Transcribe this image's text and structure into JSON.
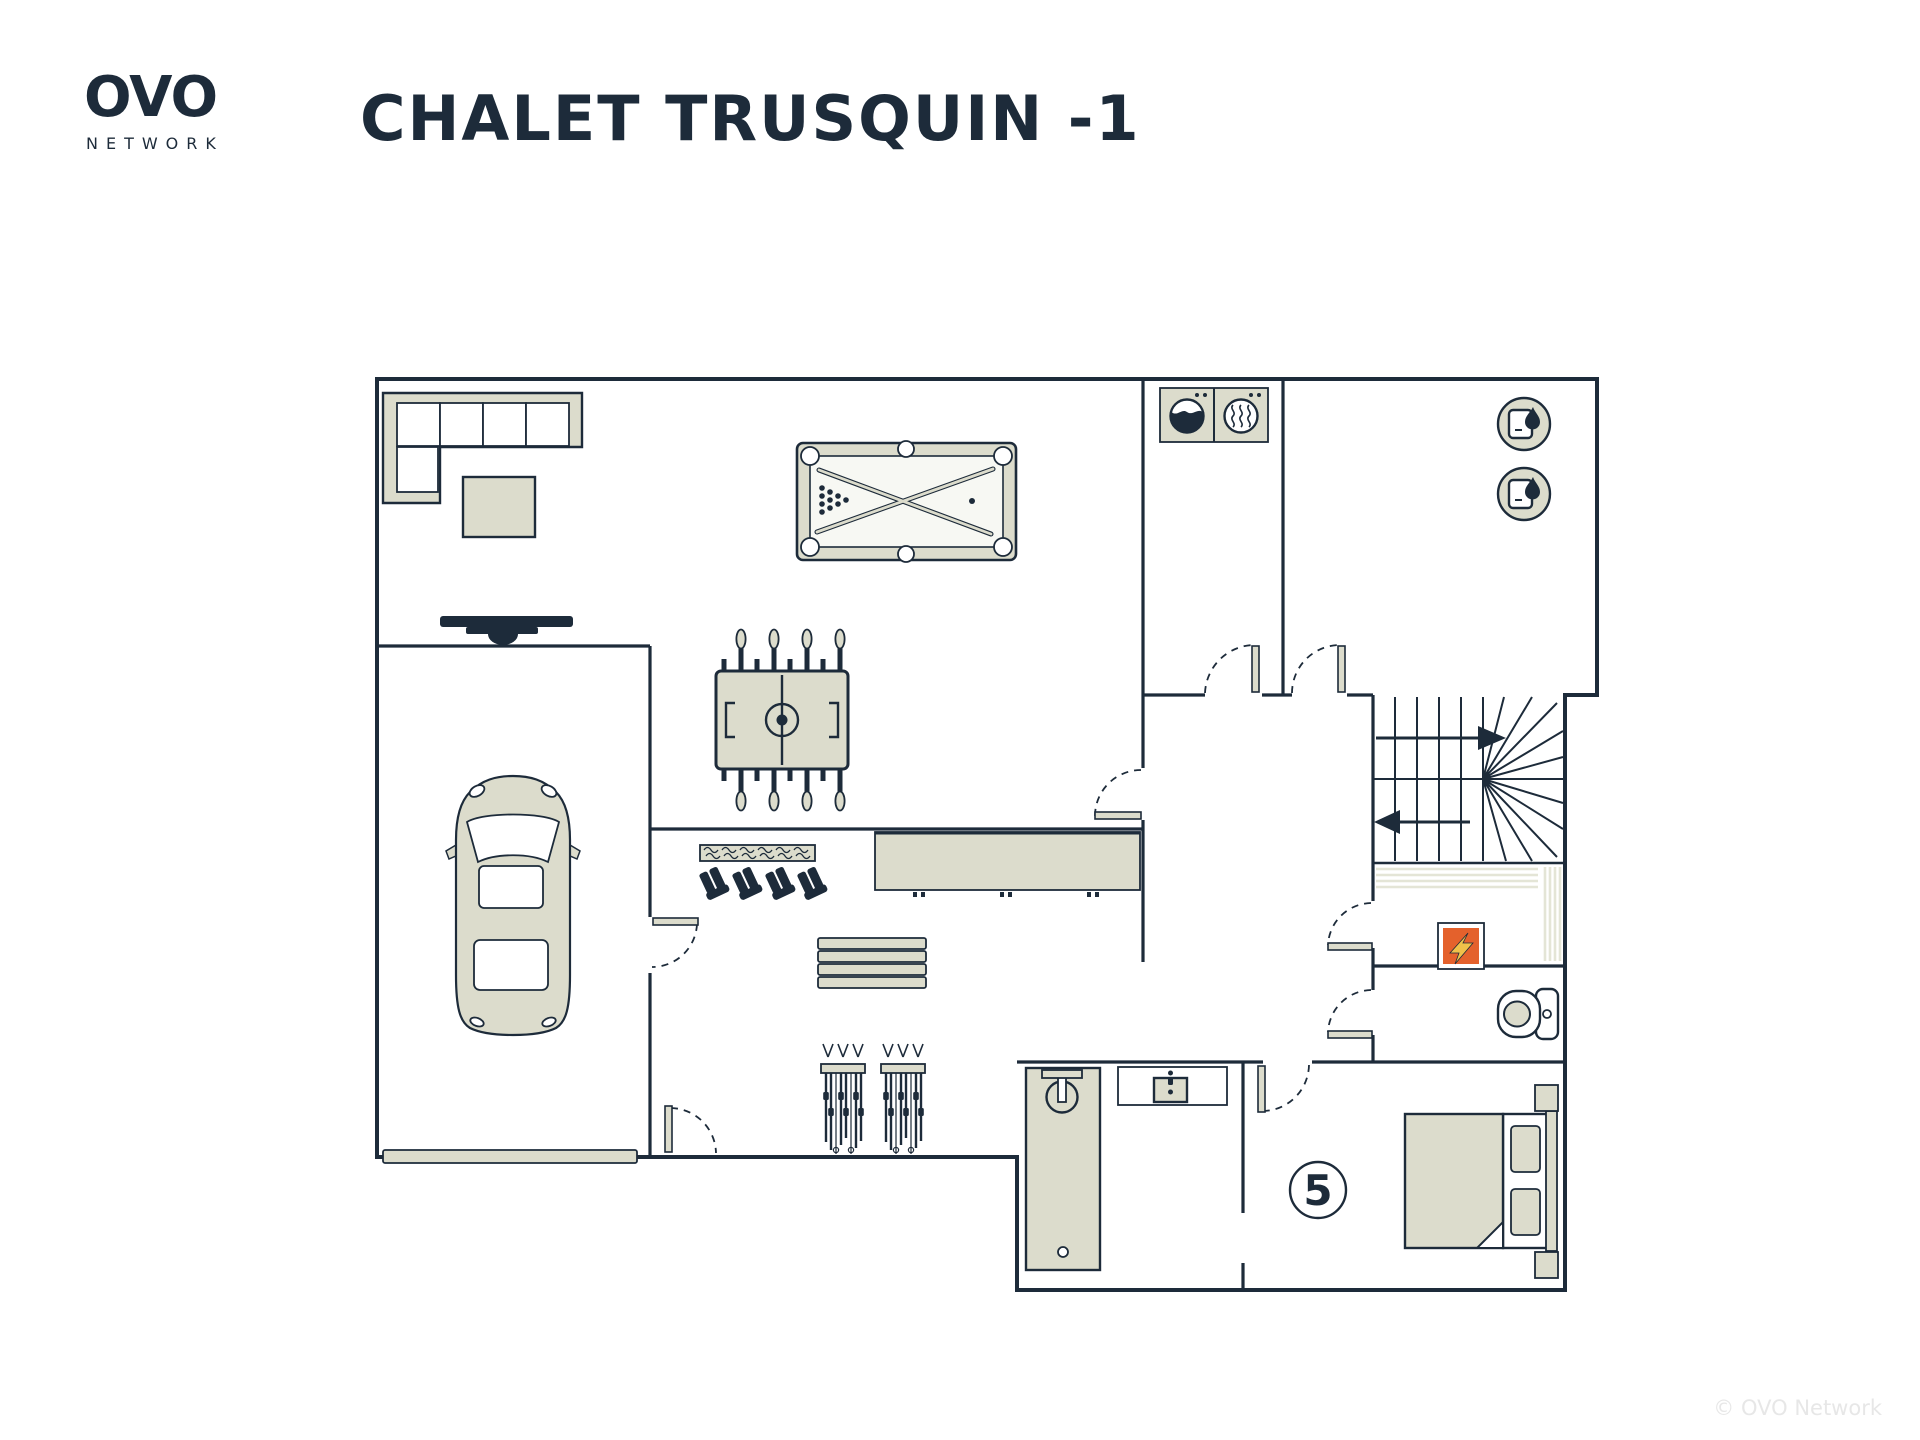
{
  "header": {
    "brand": "OVO",
    "brand_sub": "NETWORK",
    "title": "CHALET TRUSQUIN -1"
  },
  "plan": {
    "bedroom_badge": "5"
  },
  "footer": {
    "copyright": "© OVO Network"
  },
  "colors": {
    "background": "#ffffff",
    "navy": "#1d2b3a",
    "beige": "#dcdccc",
    "beige_light": "#e4e5d6",
    "playfield": "#f7f8f3",
    "orange": "#e4612c",
    "bolt_yellow": "#f0c14a",
    "copyright_gray": "#e7e7e7"
  },
  "icons": {
    "sofa-icon": "L-shaped sectional sofa, top-left lounge",
    "coffee-table-icon": "square table beside sofa",
    "tv-icon": "wall TV on garage wall",
    "pool-table-icon": "billiard table with crossed cues and ball rack",
    "foosball-table-icon": "table football with rods and handles",
    "washing-machine-icon": "front-load washer drum",
    "tumble-dryer-icon": "dryer circle with heat waves",
    "water-heater-icon": "round badge with boiler and flame (x2)",
    "stairs-icon": "switchback stair with up/down arrows and winders",
    "electrical-panel-icon": "orange square with lightning bolt",
    "toilet-icon": "WC with cistern",
    "shower-icon": "walk-in shower tray with head and drain",
    "sink-icon": "vanity with basin and faucet",
    "bed-icon": "double bed with pillows and nightstands",
    "bedroom-number-badge": "circled number",
    "counter-icon": "long sideboard in ski room",
    "boot-warmer-icon": "wall rack with 4 ski boots",
    "bench-icon": "slatted bench",
    "ski-rack-icon": "two racks with skis and poles",
    "car-icon": "car parked in garage",
    "garage-door-icon": "wide garage door slab",
    "door-icon": "door leaf with dashed swing arc"
  }
}
